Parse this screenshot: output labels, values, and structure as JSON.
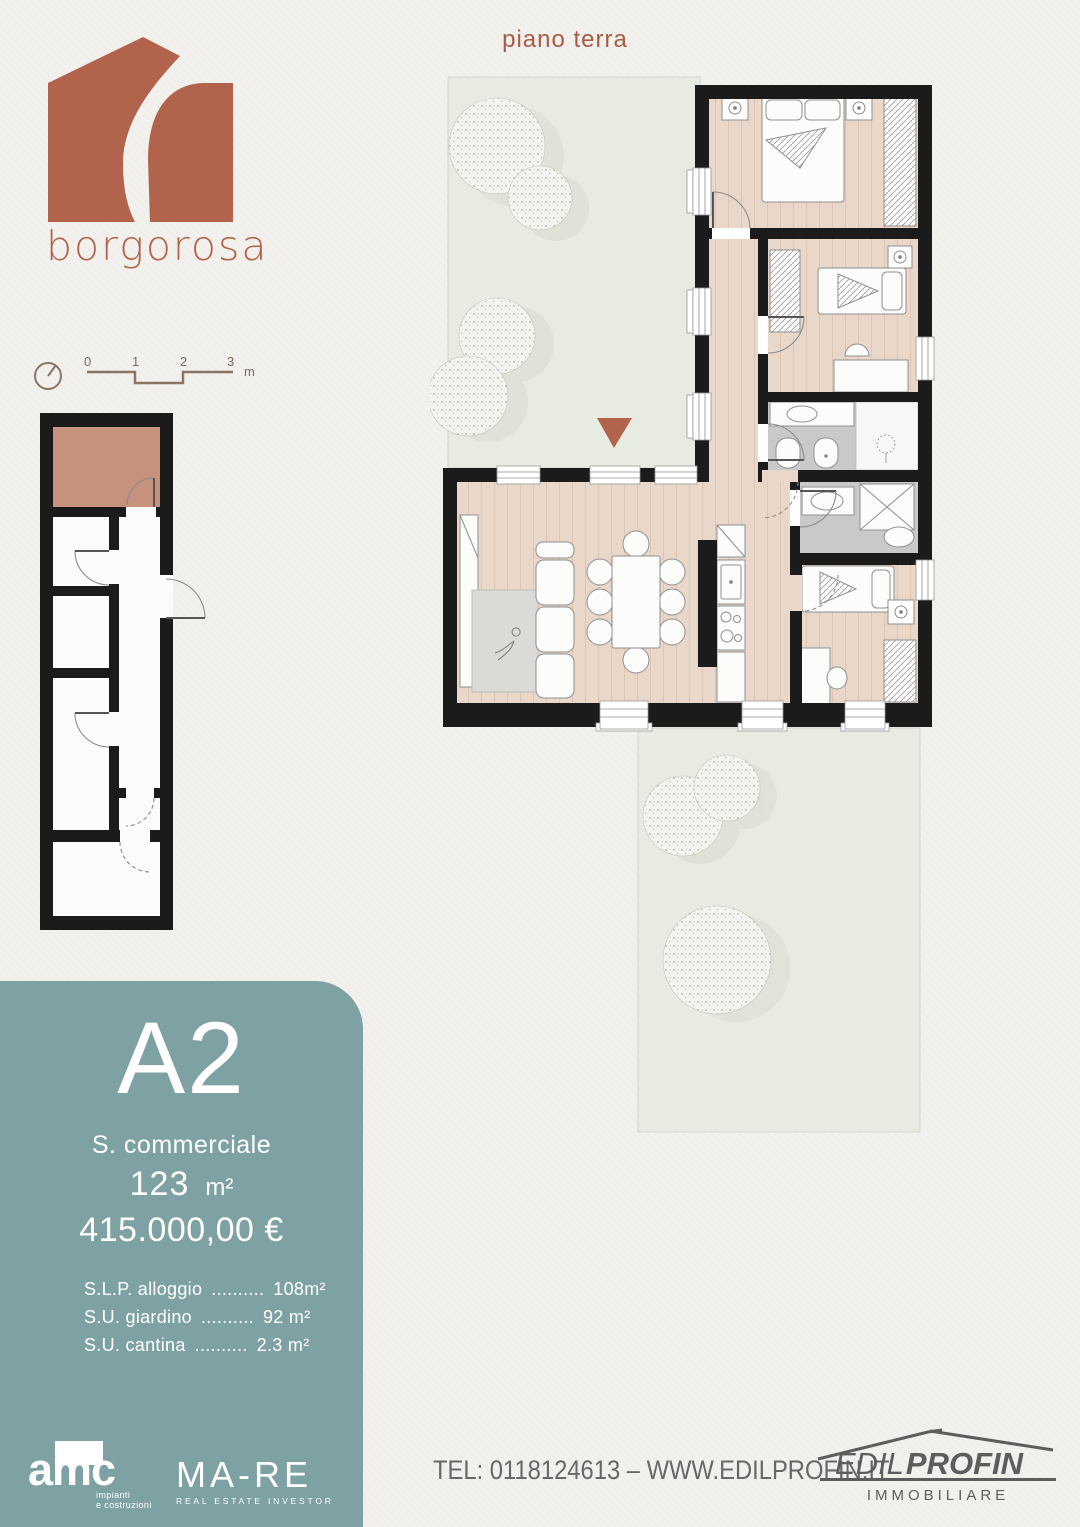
{
  "header": {
    "plan_title": "piano terra",
    "brand_name": "borgorosa"
  },
  "scale_bar": {
    "ticks": [
      "0",
      "1",
      "2",
      "3"
    ],
    "unit": "m"
  },
  "unit_panel": {
    "unit_code": "A2",
    "area_label": "S. commerciale",
    "area_value": "123",
    "area_unit": "m²",
    "price": "415.000,00 €",
    "specs": [
      {
        "label": "S.L.P. alloggio",
        "dots": "..........",
        "value": "108m²"
      },
      {
        "label": "S.U. giardino",
        "dots": "..........",
        "value": "92 m²"
      },
      {
        "label": "S.U. cantina",
        "dots": "..........",
        "value": "2.3 m²"
      }
    ]
  },
  "footer": {
    "amc_name": "amc",
    "amc_sub1": "impianti",
    "amc_sub2": "e costruzioni",
    "mare_name": "MA-RE",
    "mare_sub": "REAL ESTATE INVESTOR",
    "contact": "TEL: 0118124613 – WWW.EDILPROFIN.IT",
    "edil_part1": "EDIL",
    "edil_part2": "PROFIN",
    "edil_sub": "IMMOBILIARE"
  },
  "colors": {
    "accent_terracotta": "#b2634c",
    "panel_teal": "#7ea1a3",
    "wall_black": "#1b1b1b",
    "wood_floor": "#e9d7ca",
    "bath_gray": "#c9c9c9",
    "garden_green": "#e7ebe2",
    "cantina_highlight": "#c6917d",
    "footer_gray": "#676767"
  }
}
